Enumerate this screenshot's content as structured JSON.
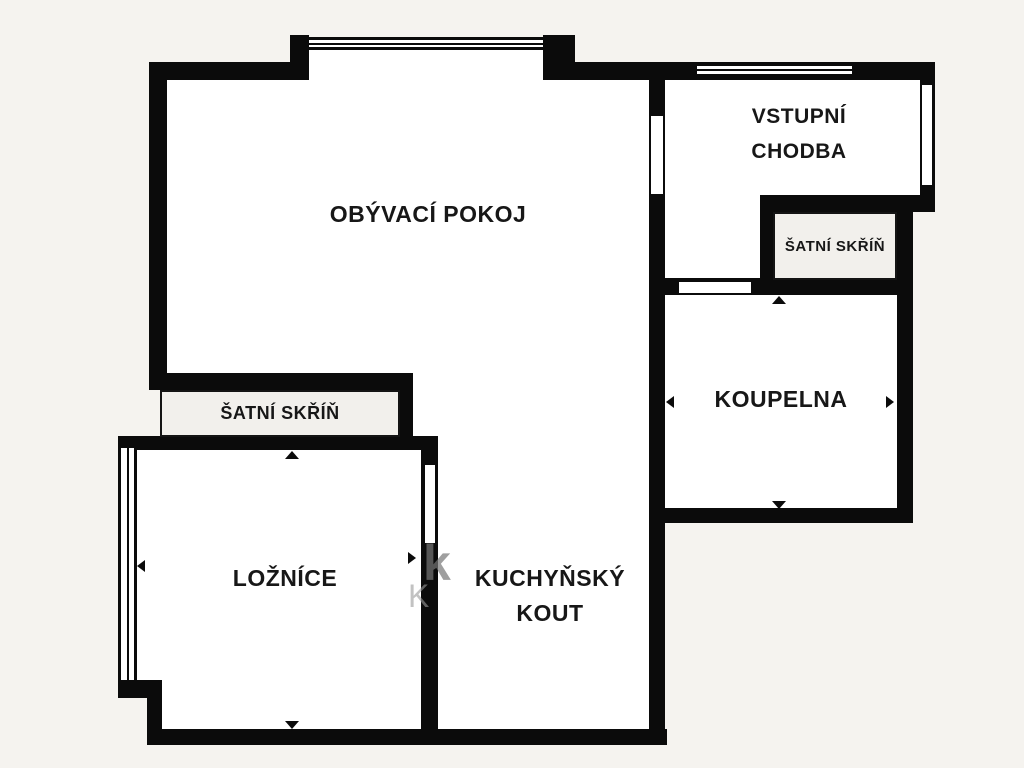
{
  "document": {
    "type": "floor-plan",
    "language": "cs"
  },
  "colors": {
    "background": "#f5f3ef",
    "wall": "#0b0b0b",
    "room_fill": "#ffffff",
    "closet_fill": "#f2f0ec",
    "label_text": "#171717",
    "watermark_dark": "#777777",
    "watermark_light": "#9a9a9a"
  },
  "rooms": {
    "living": {
      "label": "OBÝVACÍ POKOJ"
    },
    "hall": {
      "line1": "VSTUPNÍ",
      "line2": "CHODBA"
    },
    "closet_right": {
      "label": "ŠATNÍ SKŘÍŇ"
    },
    "bathroom": {
      "label": "KOUPELNA"
    },
    "closet_left": {
      "label": "ŠATNÍ SKŘÍŇ"
    },
    "bedroom": {
      "label": "LOŽNÍCE"
    },
    "kitchen": {
      "line1": "KUCHYŇSKÝ",
      "line2": "KOUT"
    }
  },
  "watermark": {
    "fragment1": "k",
    "fragment2": "K"
  }
}
